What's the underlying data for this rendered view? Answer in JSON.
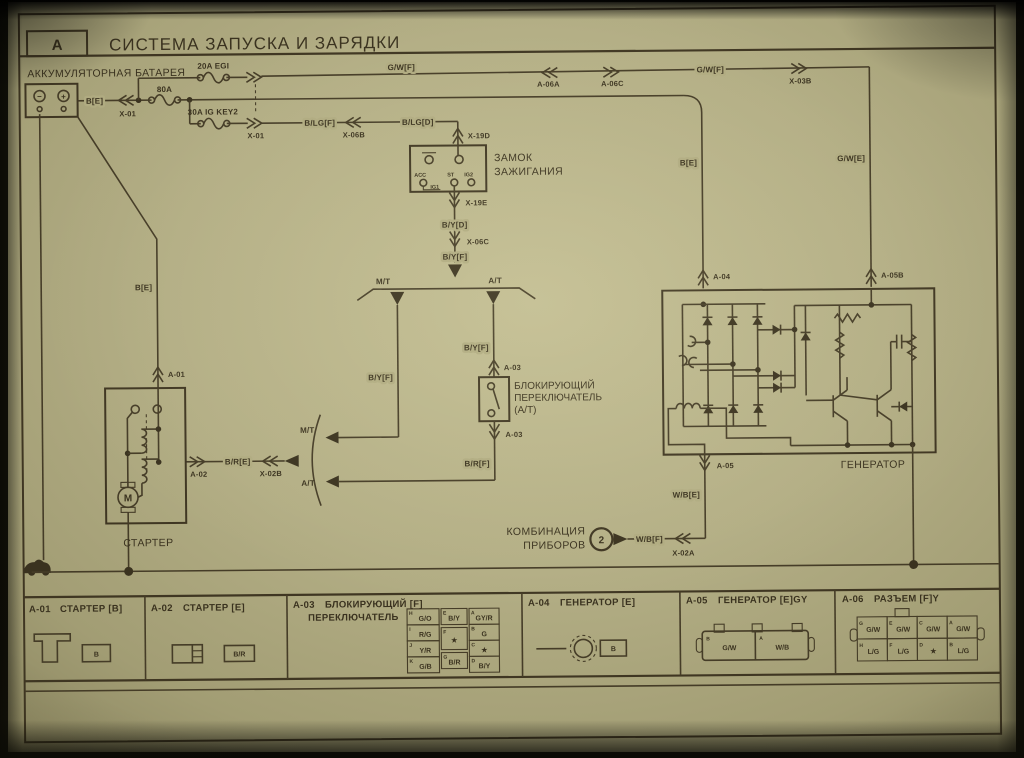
{
  "header": {
    "index_letter": "A",
    "title": "СИСТЕМА ЗАПУСКА И ЗАРЯДКИ"
  },
  "colors": {
    "paper": "#b3ae85",
    "ink": "#3a321f"
  },
  "diagram": {
    "battery": {
      "label": "АККУМУЛЯТОРНАЯ БАТАРЕЯ",
      "neg": "−",
      "pos": "+"
    },
    "ignition": {
      "line1": "ЗАМОК",
      "line2": "ЗАЖИГАНИЯ",
      "acc": "ACC",
      "ig1": "IG1",
      "st": "ST",
      "ig2": "IG2"
    },
    "inhibitor": {
      "line1": "БЛОКИРУЮЩИЙ",
      "line2": "ПЕРЕКЛЮЧАТЕЛЬ",
      "line3": "(A/T)"
    },
    "starter": {
      "label": "СТАРТЕР",
      "motor": "M"
    },
    "generator": {
      "label": "ГЕНЕРАТОР"
    },
    "cluster": {
      "line1": "КОМБИНАЦИЯ",
      "line2": "ПРИБОРОВ",
      "ref": "2"
    },
    "wires": {
      "be_batt": "B[E]",
      "x01_top": "X-01",
      "x01_bottom": "X-01",
      "fuse_80": "80A",
      "fuse_20": "20A EGI",
      "fuse_30": "30A IG KEY2",
      "gwf_left": "G/W[F]",
      "a06a": "A-06A",
      "a06c": "A-06C",
      "gwf_right": "G/W[F]",
      "x03b": "X-03B",
      "blgf": "B/LG[F]",
      "x06b": "X-06B",
      "blgd": "B/LG[D]",
      "x19d": "X-19D",
      "x19e": "X-19E",
      "byd": "B/Y[D]",
      "x06c": "X-06C",
      "byf_main": "B/Y[F]",
      "fork_mt": "M/T",
      "fork_at": "A/T",
      "byf_mt": "B/Y[F]",
      "byf_at": "B/Y[F]",
      "a03_in": "A-03",
      "a03_out": "A-03",
      "brf": "B/R[F]",
      "be_starter": "B[E]",
      "a01": "A-01",
      "a02": "A-02",
      "bre": "B/R[E]",
      "x02b": "X-02B",
      "join_mt": "M/T",
      "join_at": "A/T",
      "be_gen": "B[E]",
      "gwe": "G/W[E]",
      "a04": "A-04",
      "a05b": "A-05B",
      "a05": "A-05",
      "wbe": "W/B[E]",
      "wbf": "W/B[F]",
      "x02a": "X-02A"
    }
  },
  "bottom_strip": {
    "cells": [
      {
        "id": "A-01",
        "title": "СТАРТЕР [B]",
        "pin": "B"
      },
      {
        "id": "A-02",
        "title": "СТАРТЕР [E]",
        "pin": "B/R"
      },
      {
        "id": "A-03",
        "title": "БЛОКИРУЮЩИЙ [F]",
        "title2": "ПЕРЕКЛЮЧАТЕЛЬ",
        "col1": [
          {
            "p": "H",
            "w": "G/O"
          },
          {
            "p": "I",
            "w": "R/G"
          },
          {
            "p": "J",
            "w": "Y/R"
          },
          {
            "p": "K",
            "w": "G/B"
          }
        ],
        "col2": [
          {
            "p": "E",
            "w": "B/Y"
          },
          {
            "p": "F",
            "w": "★"
          },
          {
            "p": "G",
            "w": "B/R"
          }
        ],
        "col3": [
          {
            "p": "A",
            "w": "GY/R"
          },
          {
            "p": "B",
            "w": "G"
          },
          {
            "p": "C",
            "w": "★"
          },
          {
            "p": "D",
            "w": "B/Y"
          }
        ]
      },
      {
        "id": "A-04",
        "title": "ГЕНЕРАТОР [E]",
        "pin": "B"
      },
      {
        "id": "A-05",
        "title": "ГЕНЕРАТОР [E]GY",
        "pins": [
          {
            "p": "B",
            "w": "G/W"
          },
          {
            "p": "A",
            "w": "W/B"
          }
        ]
      },
      {
        "id": "A-06",
        "title": "РАЗЪЕМ [F]Y",
        "row1": [
          {
            "p": "G",
            "w": "G/W"
          },
          {
            "p": "E",
            "w": "G/W"
          },
          {
            "p": "C",
            "w": "G/W"
          },
          {
            "p": "A",
            "w": "G/W"
          }
        ],
        "row2": [
          {
            "p": "H",
            "w": "L/G"
          },
          {
            "p": "F",
            "w": "L/G"
          },
          {
            "p": "D",
            "w": "★"
          },
          {
            "p": "B",
            "w": "L/G"
          }
        ]
      }
    ]
  }
}
